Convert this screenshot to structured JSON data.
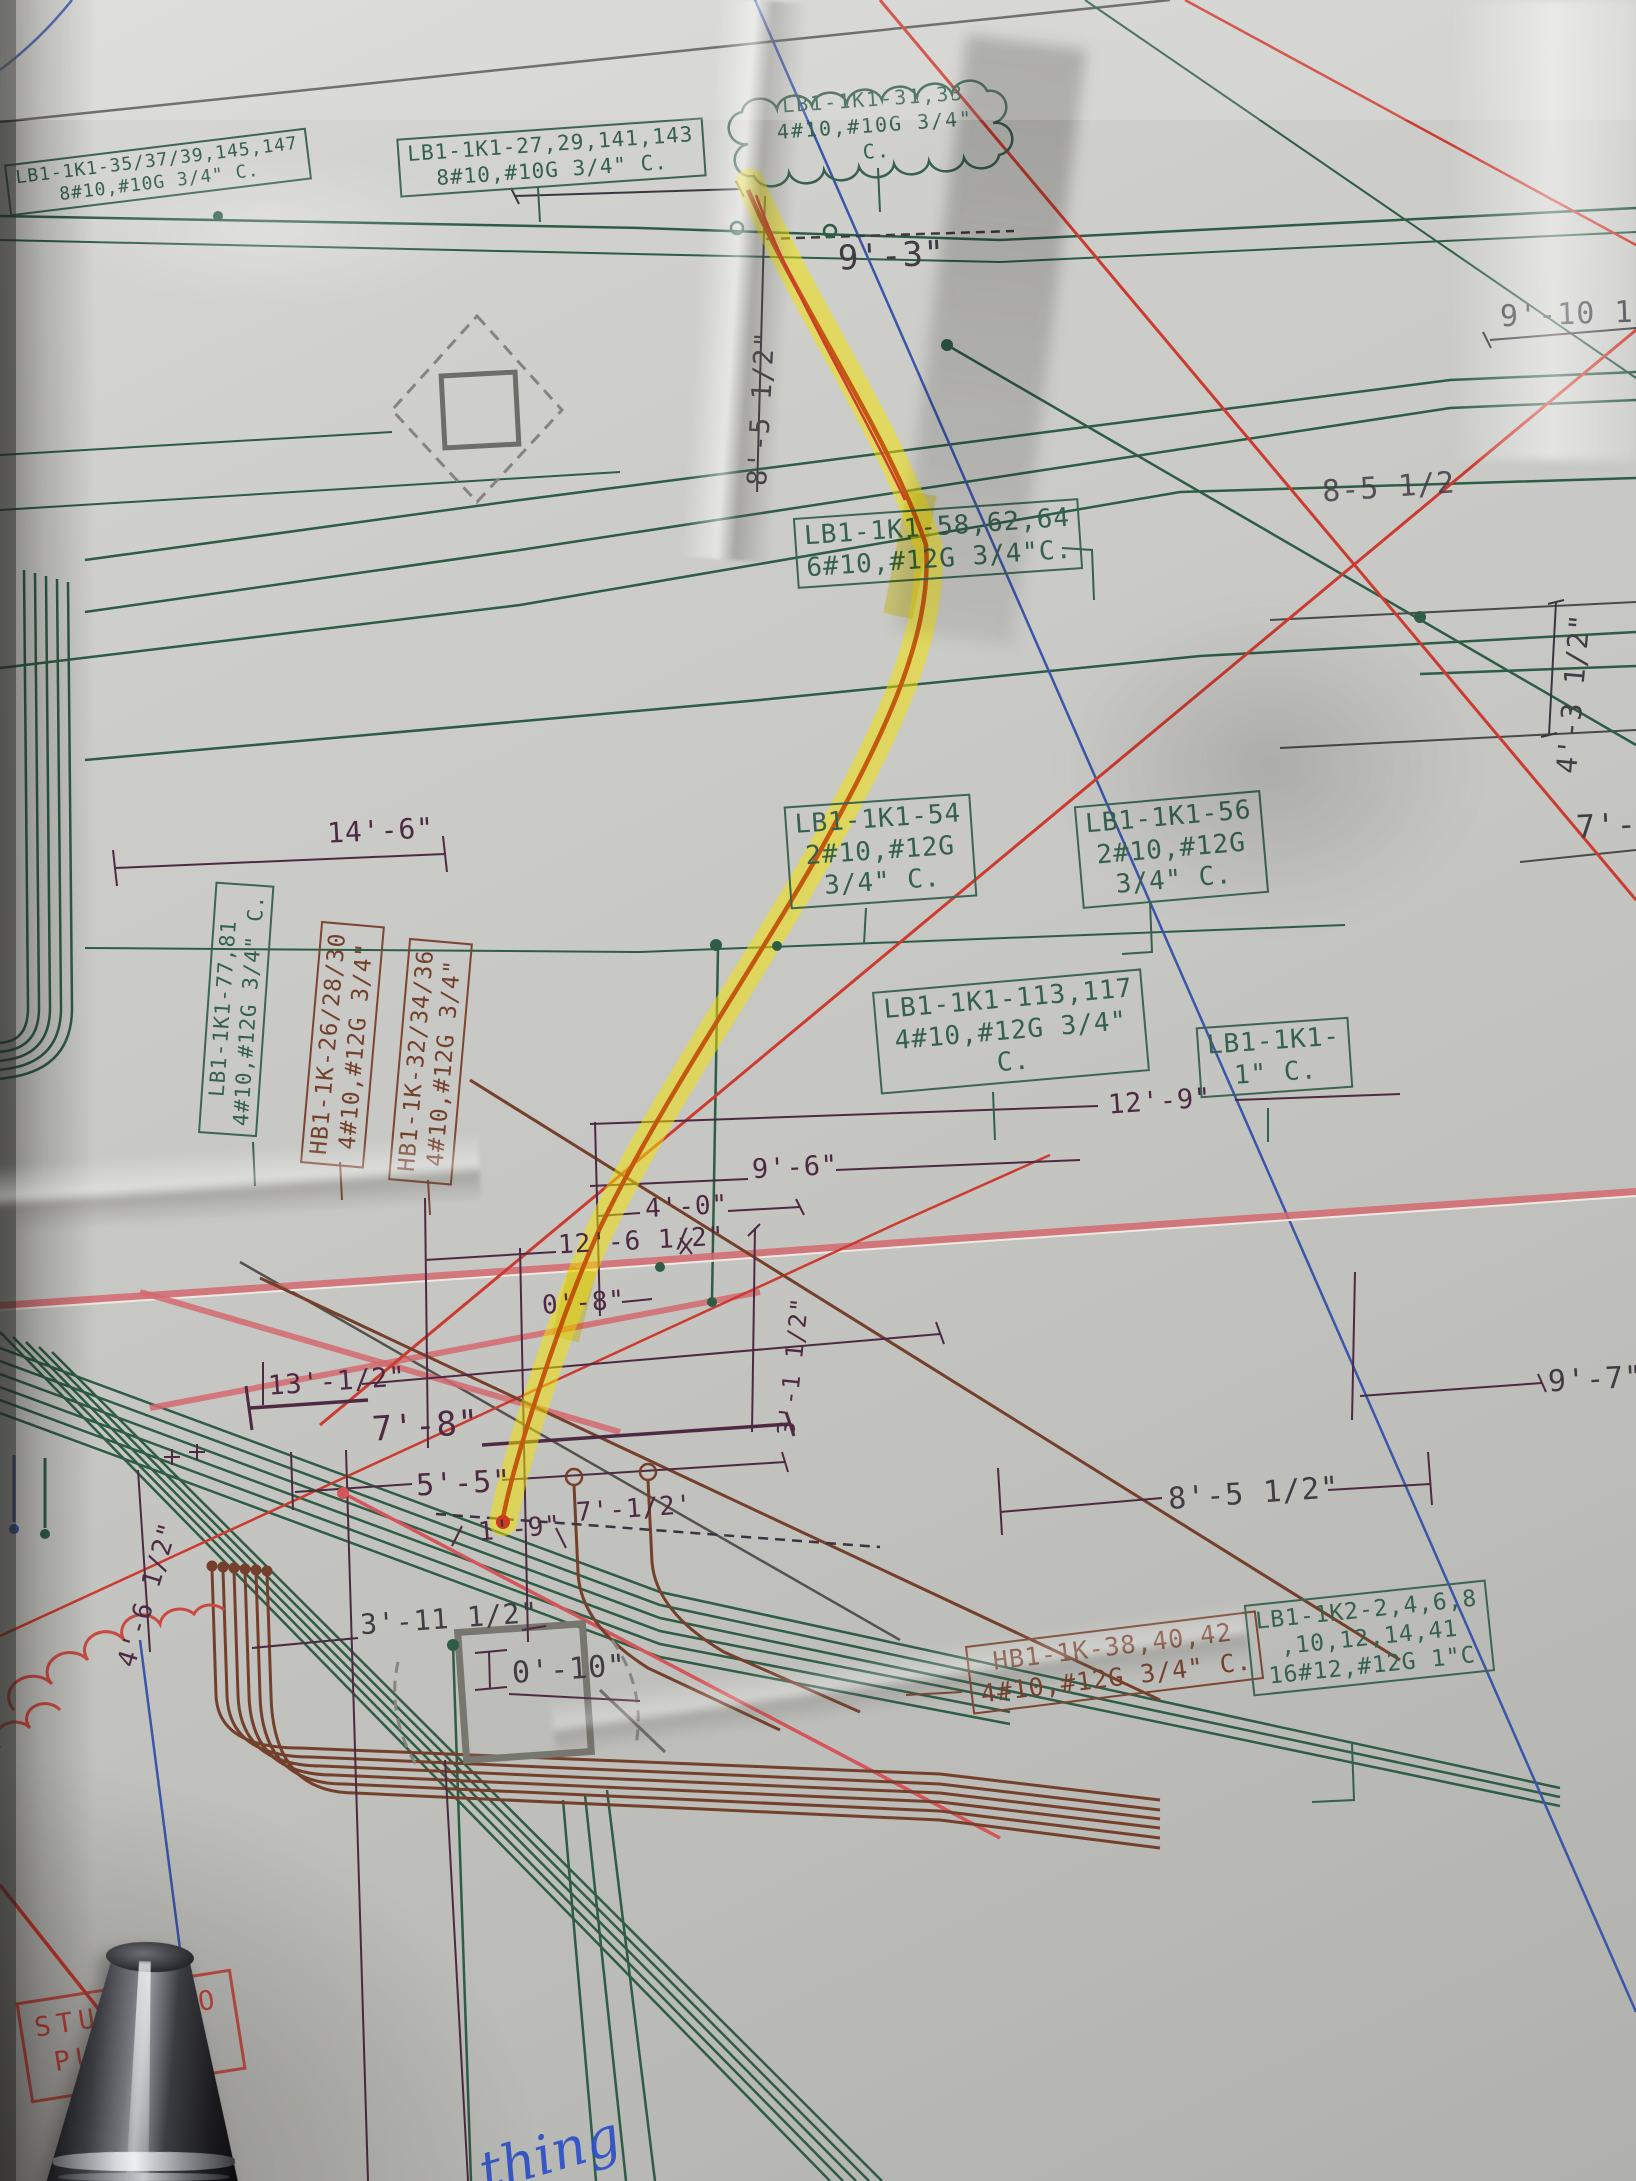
{
  "callouts": {
    "lb1_35": {
      "l1": "LB1-1K1-35/37/39,145,147",
      "l2": "8#10,#10G 3/4\" C."
    },
    "lb1_27": {
      "l1": "LB1-1K1-27,29,141,143",
      "l2": "8#10,#10G 3/4\" C."
    },
    "cloud31": {
      "l1": "LB1-1K1-31,33",
      "l2": "4#10,#10G 3/4\" C."
    },
    "lb1_58": {
      "l1": "LB1-1K1-58,62,64",
      "l2": "6#10,#12G 3/4\"C."
    },
    "lb1_54": {
      "l1": "LB1-1K1-54",
      "l2": "2#10,#12G",
      "l3": "3/4\" C."
    },
    "lb1_56": {
      "l1": "LB1-1K1-56",
      "l2": "2#10,#12G",
      "l3": "3/4\" C."
    },
    "lb1_77": {
      "l1": "LB1-1K1-77,81",
      "l2": "4#10,#12G 3/4\" C."
    },
    "hb1_26": {
      "l1": "HB1-1K-26/28/30",
      "l2": "4#10,#12G 3/4\""
    },
    "hb1_32": {
      "l1": "HB1-1K-32/34/36",
      "l2": "4#10,#12G 3/4\""
    },
    "lb1_113": {
      "l1": "LB1-1K1-113,117",
      "l2": "4#10,#12G 3/4\"",
      "l3": "C."
    },
    "lb1_1c": {
      "l1": "LB1-1K1-",
      "l2": "1\" C."
    },
    "hb1_38": {
      "l1": "HB1-1K-38,40,42",
      "l2": "4#10,#12G 3/4\" C."
    },
    "lb1_k2": {
      "l1": "LB1-1K2-2,4,6,8",
      "l2": ",10,12,14,41",
      "l3": "16#12,#12G 1\"C"
    }
  },
  "dims": {
    "d9_3": "9'-3\"",
    "d9_10": "9'-10 1/2\"",
    "d8_5_top": "8'-5 1/2\"",
    "d8_5_right": "8-5 1/2",
    "d4_3": "4'-3 1/2\"",
    "d7_3": "7'-3",
    "d14_6": "14'-6\"",
    "d12_9": "12'-9\"",
    "d9_6": "9'-6\"",
    "d4_0": "4'-0\"",
    "d12_6": "12'-6 1/2\"",
    "d0_8": "0'-8\"",
    "d3_1": "3'-1 1/2\"",
    "d13_05": "13'-1/2\"",
    "d7_8": "7'-8\"",
    "d5_5": "5'-5\"",
    "d7_05": "7'-1/2'",
    "d1_9": "1'-9\"",
    "d9_7": "9'-7\"",
    "d8_5_bot": "8'-5 1/2\"",
    "d4_6": "4'-6 1/2\"",
    "d3_11": "3'-11 1/2\"",
    "d0_10": "0'-10\""
  },
  "stamp": {
    "line1_left": "STUB",
    "line1_right": "O",
    "line2": "PU"
  },
  "handwriting": {
    "text": "thing"
  },
  "colors": {
    "green": "#2e5c44",
    "brown": "#74402c",
    "red": "#cc3b30",
    "pink": "#d4696f",
    "blue": "#3a56a8",
    "maroon": "#4d2a42",
    "highlight": "#f3e200",
    "circuit": "#c2590f",
    "stamp": "#c73c34"
  }
}
